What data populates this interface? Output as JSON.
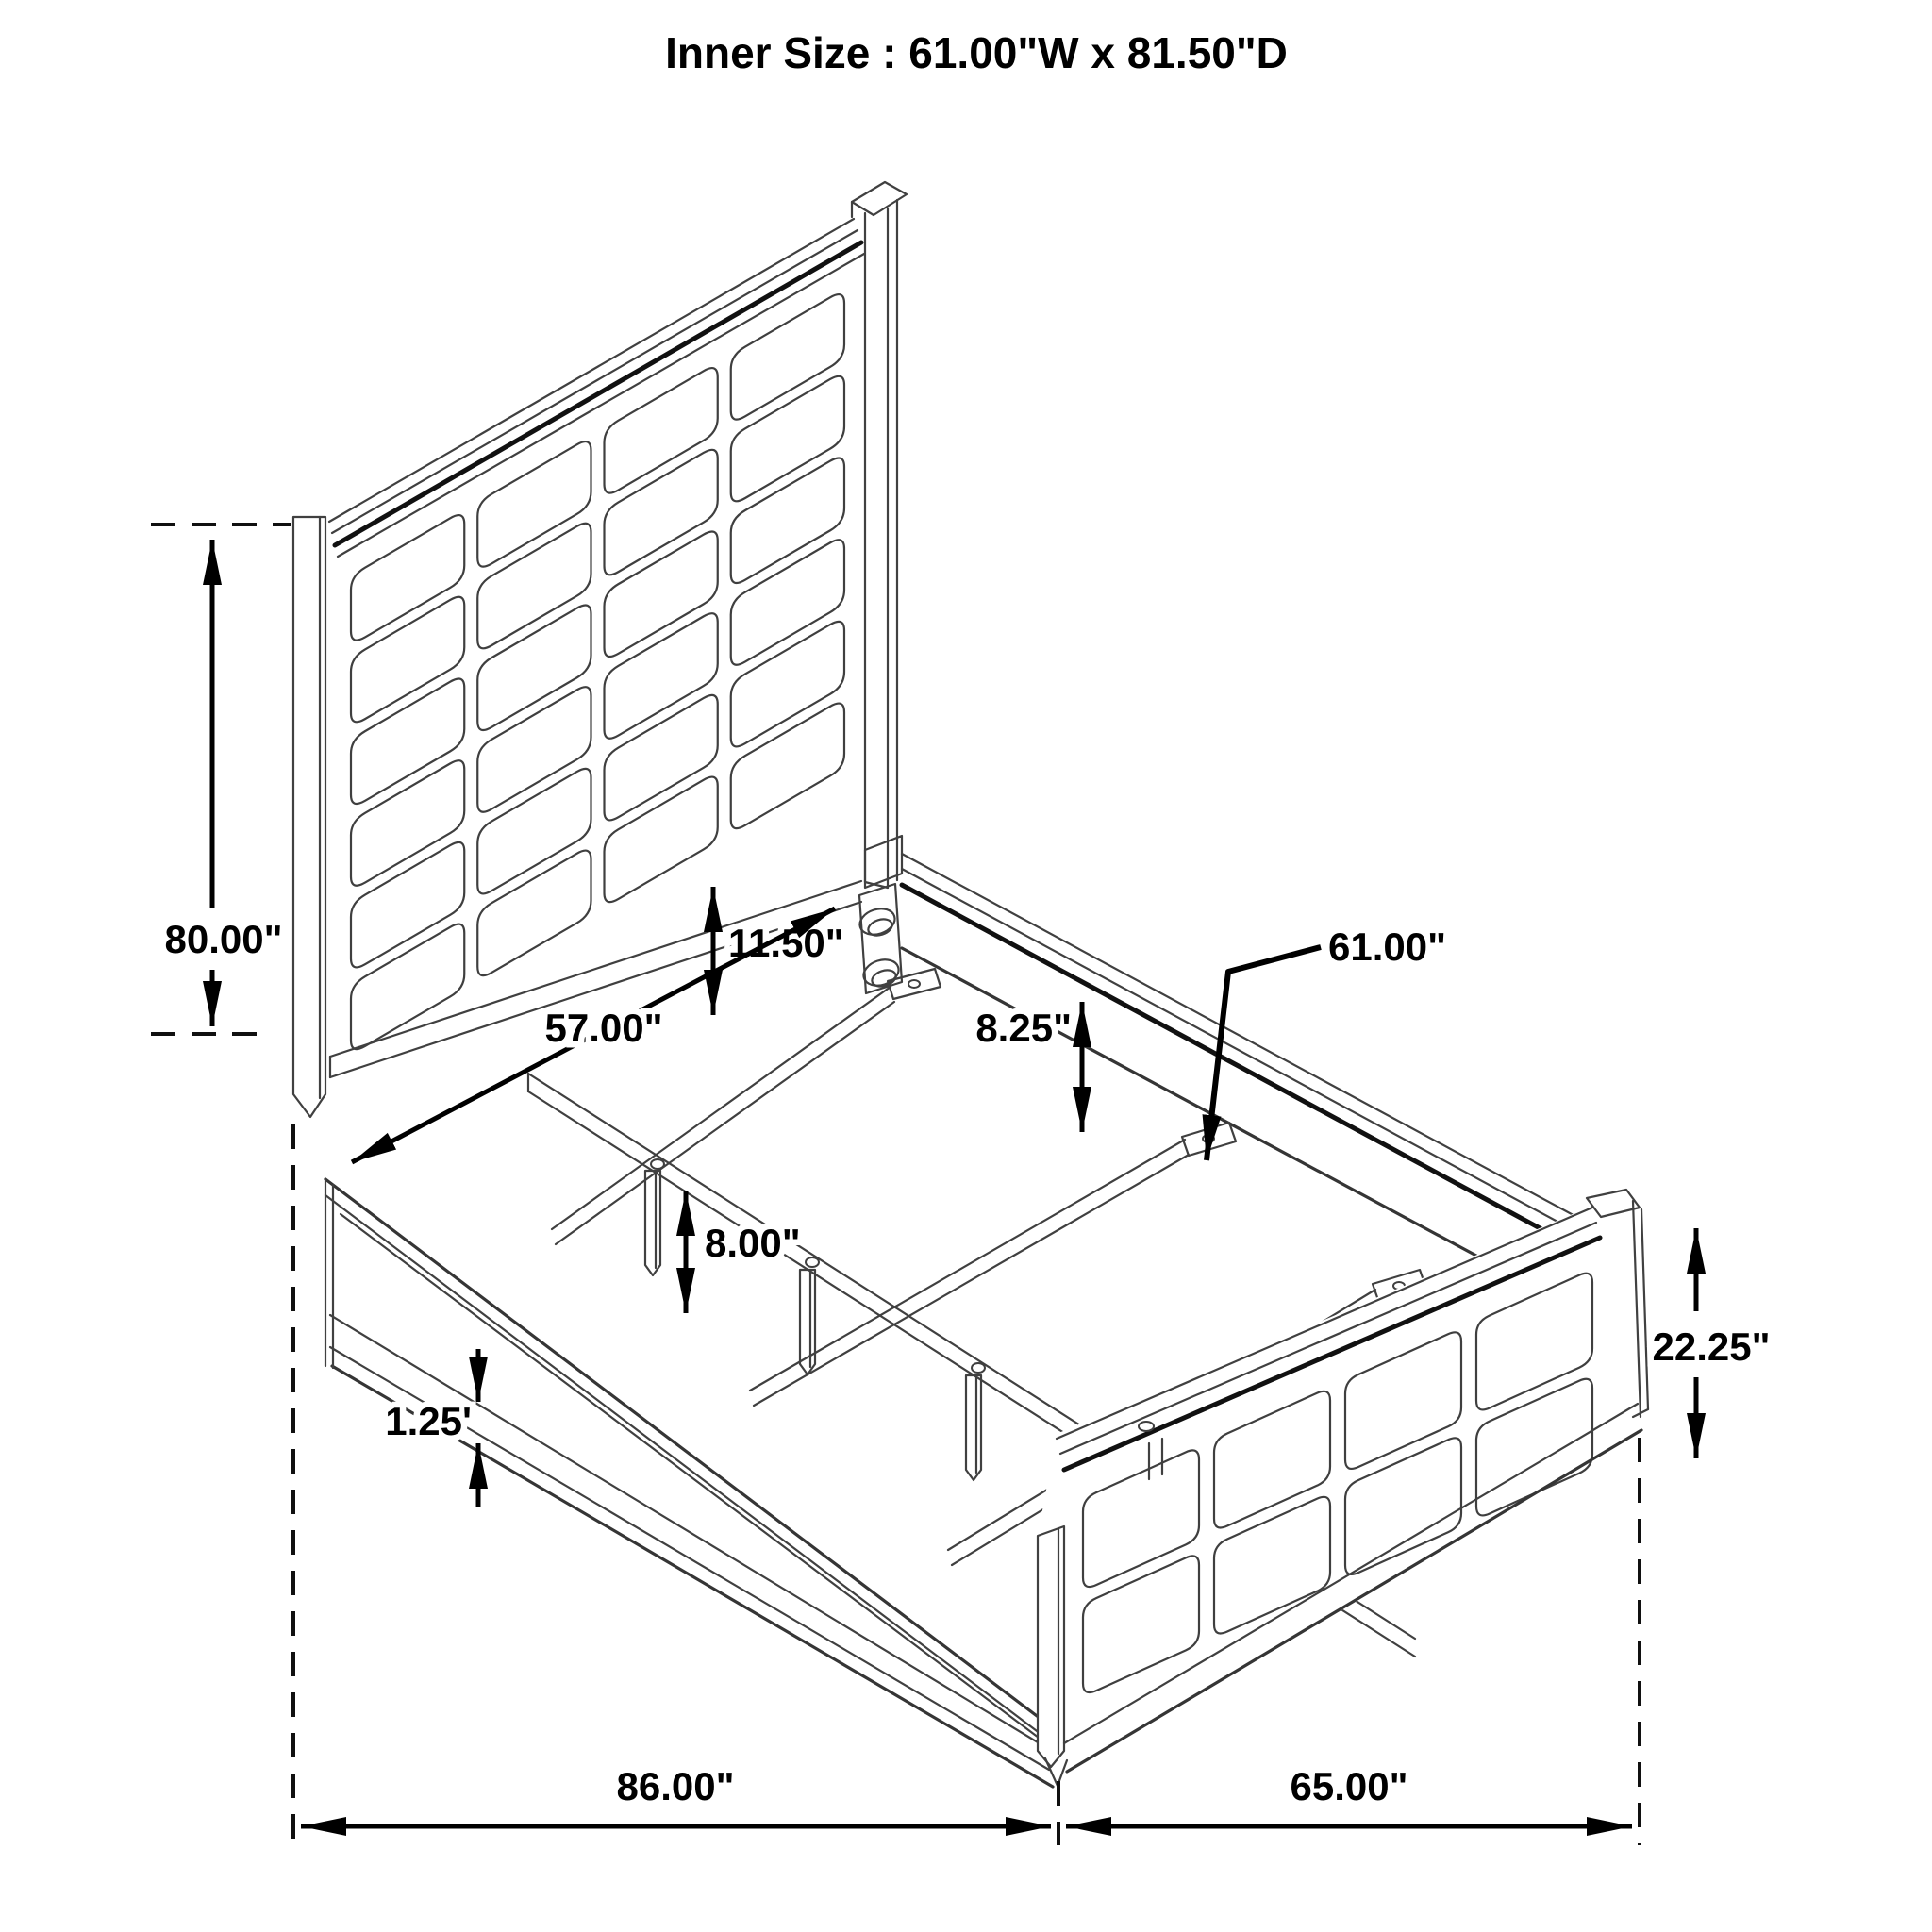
{
  "title": "Inner Size : 61.00\"W x 81.50\"D",
  "dimensions": {
    "headboard_height": "80.00\"",
    "headboard_panel_drop": "11.50\"",
    "headboard_inner_width": "57.00\"",
    "rail_top_to_slat": "8.25\"",
    "slat_leg_height": "8.00\"",
    "slat_length": "61.00\"",
    "footboard_height": "22.25\"",
    "rail_lip": "1.25'",
    "overall_length": "86.00\"",
    "overall_width": "65.00\""
  },
  "colors": {
    "line": "#404040",
    "dimension": "#000000",
    "background": "#ffffff"
  }
}
